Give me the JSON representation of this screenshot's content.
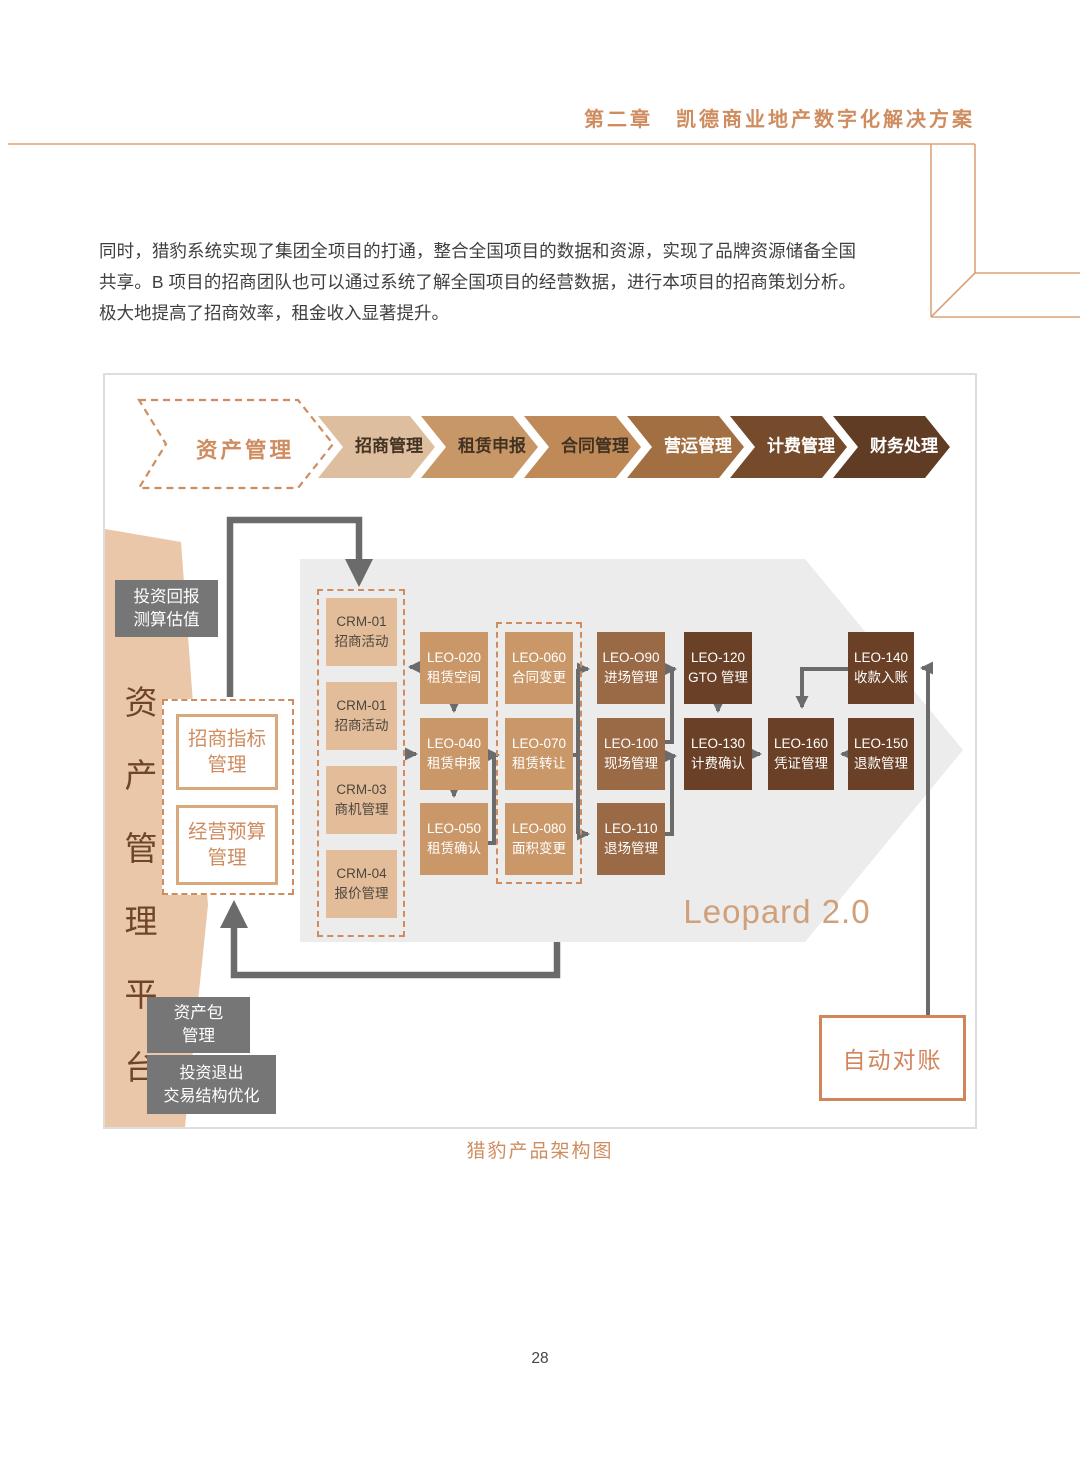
{
  "page": {
    "chapter_header": "第二章　凯德商业地产数字化解决方案",
    "body_paragraph": "同时，猎豹系统实现了集团全项目的打通，整合全国项目的数据和资源，实现了品牌资源储备全国共享。B 项目的招商团队也可以通过系统了解全国项目的经营数据，进行本项目的招商策划分析。极大地提高了招商效率，租金收入显著提升。",
    "figure_caption": "猎豹产品架构图",
    "page_number": "28"
  },
  "flow": {
    "steps": [
      {
        "label": "资产管理",
        "bg": "#ffffff",
        "text_color": "#cf8c5f",
        "style": "dashed"
      },
      {
        "label": "招商管理",
        "bg": "#ddbf9f",
        "text_color": "#433222"
      },
      {
        "label": "租赁申报",
        "bg": "#c89767",
        "text_color": "#433222"
      },
      {
        "label": "合同管理",
        "bg": "#c08a58",
        "text_color": "#433222"
      },
      {
        "label": "营运管理",
        "bg": "#a26f42",
        "text_color": "#ffffff"
      },
      {
        "label": "计费管理",
        "bg": "#764b2b",
        "text_color": "#ffffff"
      },
      {
        "label": "财务处理",
        "bg": "#603c25",
        "text_color": "#ffffff"
      }
    ]
  },
  "platform": {
    "vertical_label": "资产管理平台",
    "investment_return": "投资回报\n测算估值",
    "target_box_1": "招商指标\n管理",
    "target_box_2": "经营预算\n管理",
    "asset_package": "资产包\n管理",
    "investment_exit": "投资退出\n交易结构优化"
  },
  "diagram": {
    "leopard_label": "Leopard 2.0",
    "auto_reconciliation": "自动对账",
    "modules": {
      "crm": [
        {
          "code": "CRM-01",
          "name": "招商活动"
        },
        {
          "code": "CRM-01",
          "name": "招商活动"
        },
        {
          "code": "CRM-03",
          "name": "商机管理"
        },
        {
          "code": "CRM-04",
          "name": "报价管理"
        }
      ],
      "leasing": [
        {
          "code": "LEO-020",
          "name": "租赁空间"
        },
        {
          "code": "LEO-040",
          "name": "租赁申报"
        },
        {
          "code": "LEO-050",
          "name": "租赁确认"
        }
      ],
      "contract": [
        {
          "code": "LEO-060",
          "name": "合同变更"
        },
        {
          "code": "LEO-070",
          "name": "租赁转让"
        },
        {
          "code": "LEO-080",
          "name": "面积变更"
        }
      ],
      "site": [
        {
          "code": "LEO-O90",
          "name": "进场管理"
        },
        {
          "code": "LEO-100",
          "name": "现场管理"
        },
        {
          "code": "LEO-110",
          "name": "退场管理"
        }
      ],
      "billing": [
        {
          "code": "LEO-120",
          "name": "GTO 管理"
        },
        {
          "code": "LEO-130",
          "name": "计费确认"
        }
      ],
      "finance": [
        {
          "code": "LEO-140",
          "name": "收款入账"
        },
        {
          "code": "LEO-160",
          "name": "凭证管理"
        },
        {
          "code": "LEO-150",
          "name": "退款管理"
        }
      ]
    }
  },
  "colors": {
    "accent_orange": "#cf8c5f",
    "tan_module": "#ca9868",
    "crm_module": "#e3bd9a",
    "brown_module": "#9a6945",
    "dark_module": "#6a4026",
    "gray_box": "#767676",
    "gray_arrow_bg": "#ececec",
    "tan_polygon": "#eac7a8",
    "connector": "#6b6b6b"
  }
}
